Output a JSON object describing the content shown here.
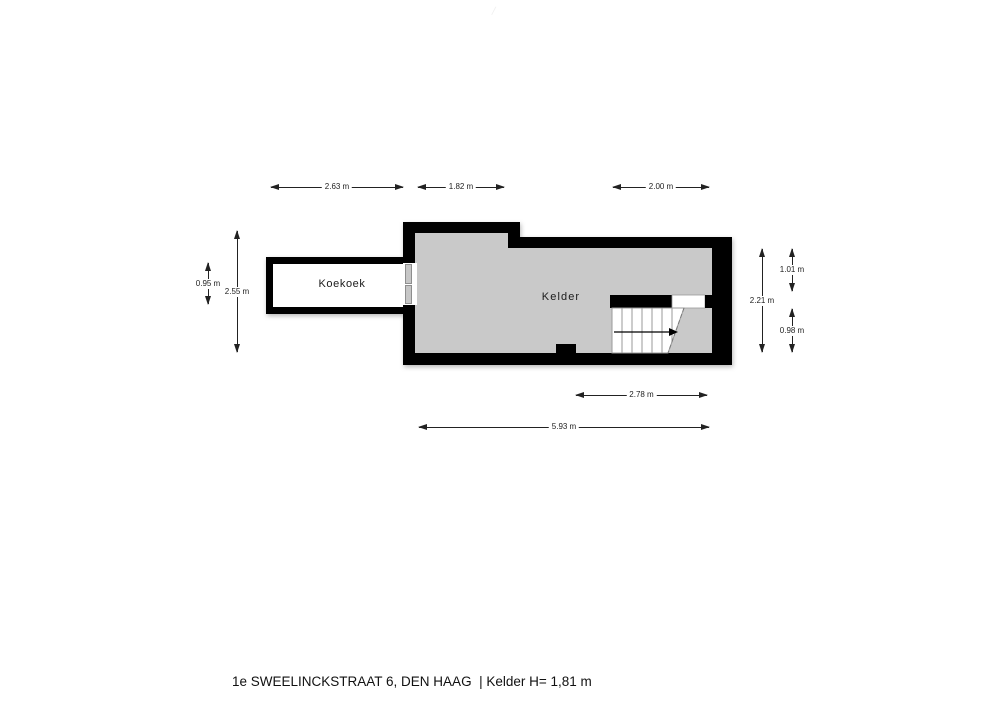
{
  "watermark": "/",
  "plan": {
    "rooms": {
      "koekoek": {
        "label": "Koekoek"
      },
      "kelder": {
        "label": "Kelder"
      }
    },
    "dimensions": {
      "top_koekoek_width": "2.63 m",
      "top_kelder_left_width": "1.82 m",
      "top_stairs_width": "2.00 m",
      "left_koekoek_height": "0.95 m",
      "left_kelder_height": "2.55 m",
      "right_kelder_height": "2.21 m",
      "right_upper_height": "1.01 m",
      "right_lower_height": "0.98 m",
      "bottom_stairs_span": "2.78 m",
      "bottom_kelder_length": "5.93 m"
    },
    "colors": {
      "wall": "#000000",
      "kelder_floor": "#c9c9c9",
      "koekoek_floor": "#ffffff",
      "dimension_ink": "#222222"
    }
  },
  "footer": {
    "title": "1e SWEELINCKSTRAAT 6, DEN HAAG  | Kelder H= 1,81 m"
  }
}
